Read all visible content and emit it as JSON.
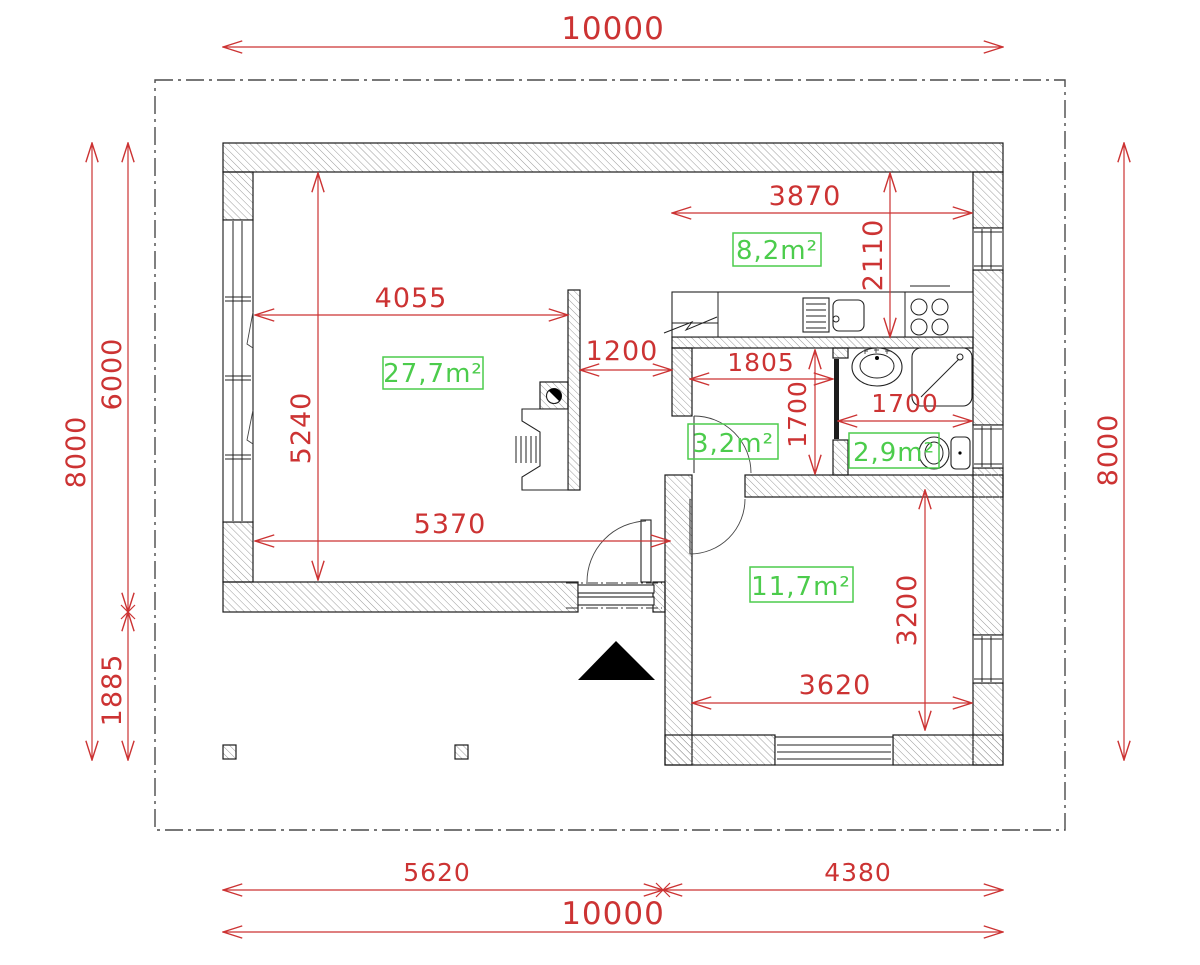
{
  "colors": {
    "dimension_red": "#cc3333",
    "area_green": "#4ccc4c",
    "wall_line": "#1a1a1a",
    "hatch_gray": "#8f8f8f",
    "boundary_gray": "#4a4a4a"
  },
  "dims": {
    "site_top": "10000",
    "site_bottom": "10000",
    "bottom_left": "5620",
    "bottom_right": "4380",
    "left_total": "8000",
    "left_main": "6000",
    "left_porch": "1885",
    "right_total": "8000",
    "living_width": "4055",
    "living_height": "5240",
    "living_bottom_width": "5370",
    "opening_width": "1200",
    "kitchen_width": "3870",
    "kitchen_depth": "2110",
    "hall_width": "1805",
    "hall_depth": "1700",
    "bath_width": "1700",
    "bedroom_width": "3620",
    "bedroom_depth": "3200"
  },
  "rooms": {
    "living": {
      "area": "27,7m²"
    },
    "kitchen": {
      "area": "8,2m²"
    },
    "hall": {
      "area": "3,2m²"
    },
    "bath": {
      "area": "2,9m²"
    },
    "bedroom": {
      "area": "11,7m²"
    }
  }
}
